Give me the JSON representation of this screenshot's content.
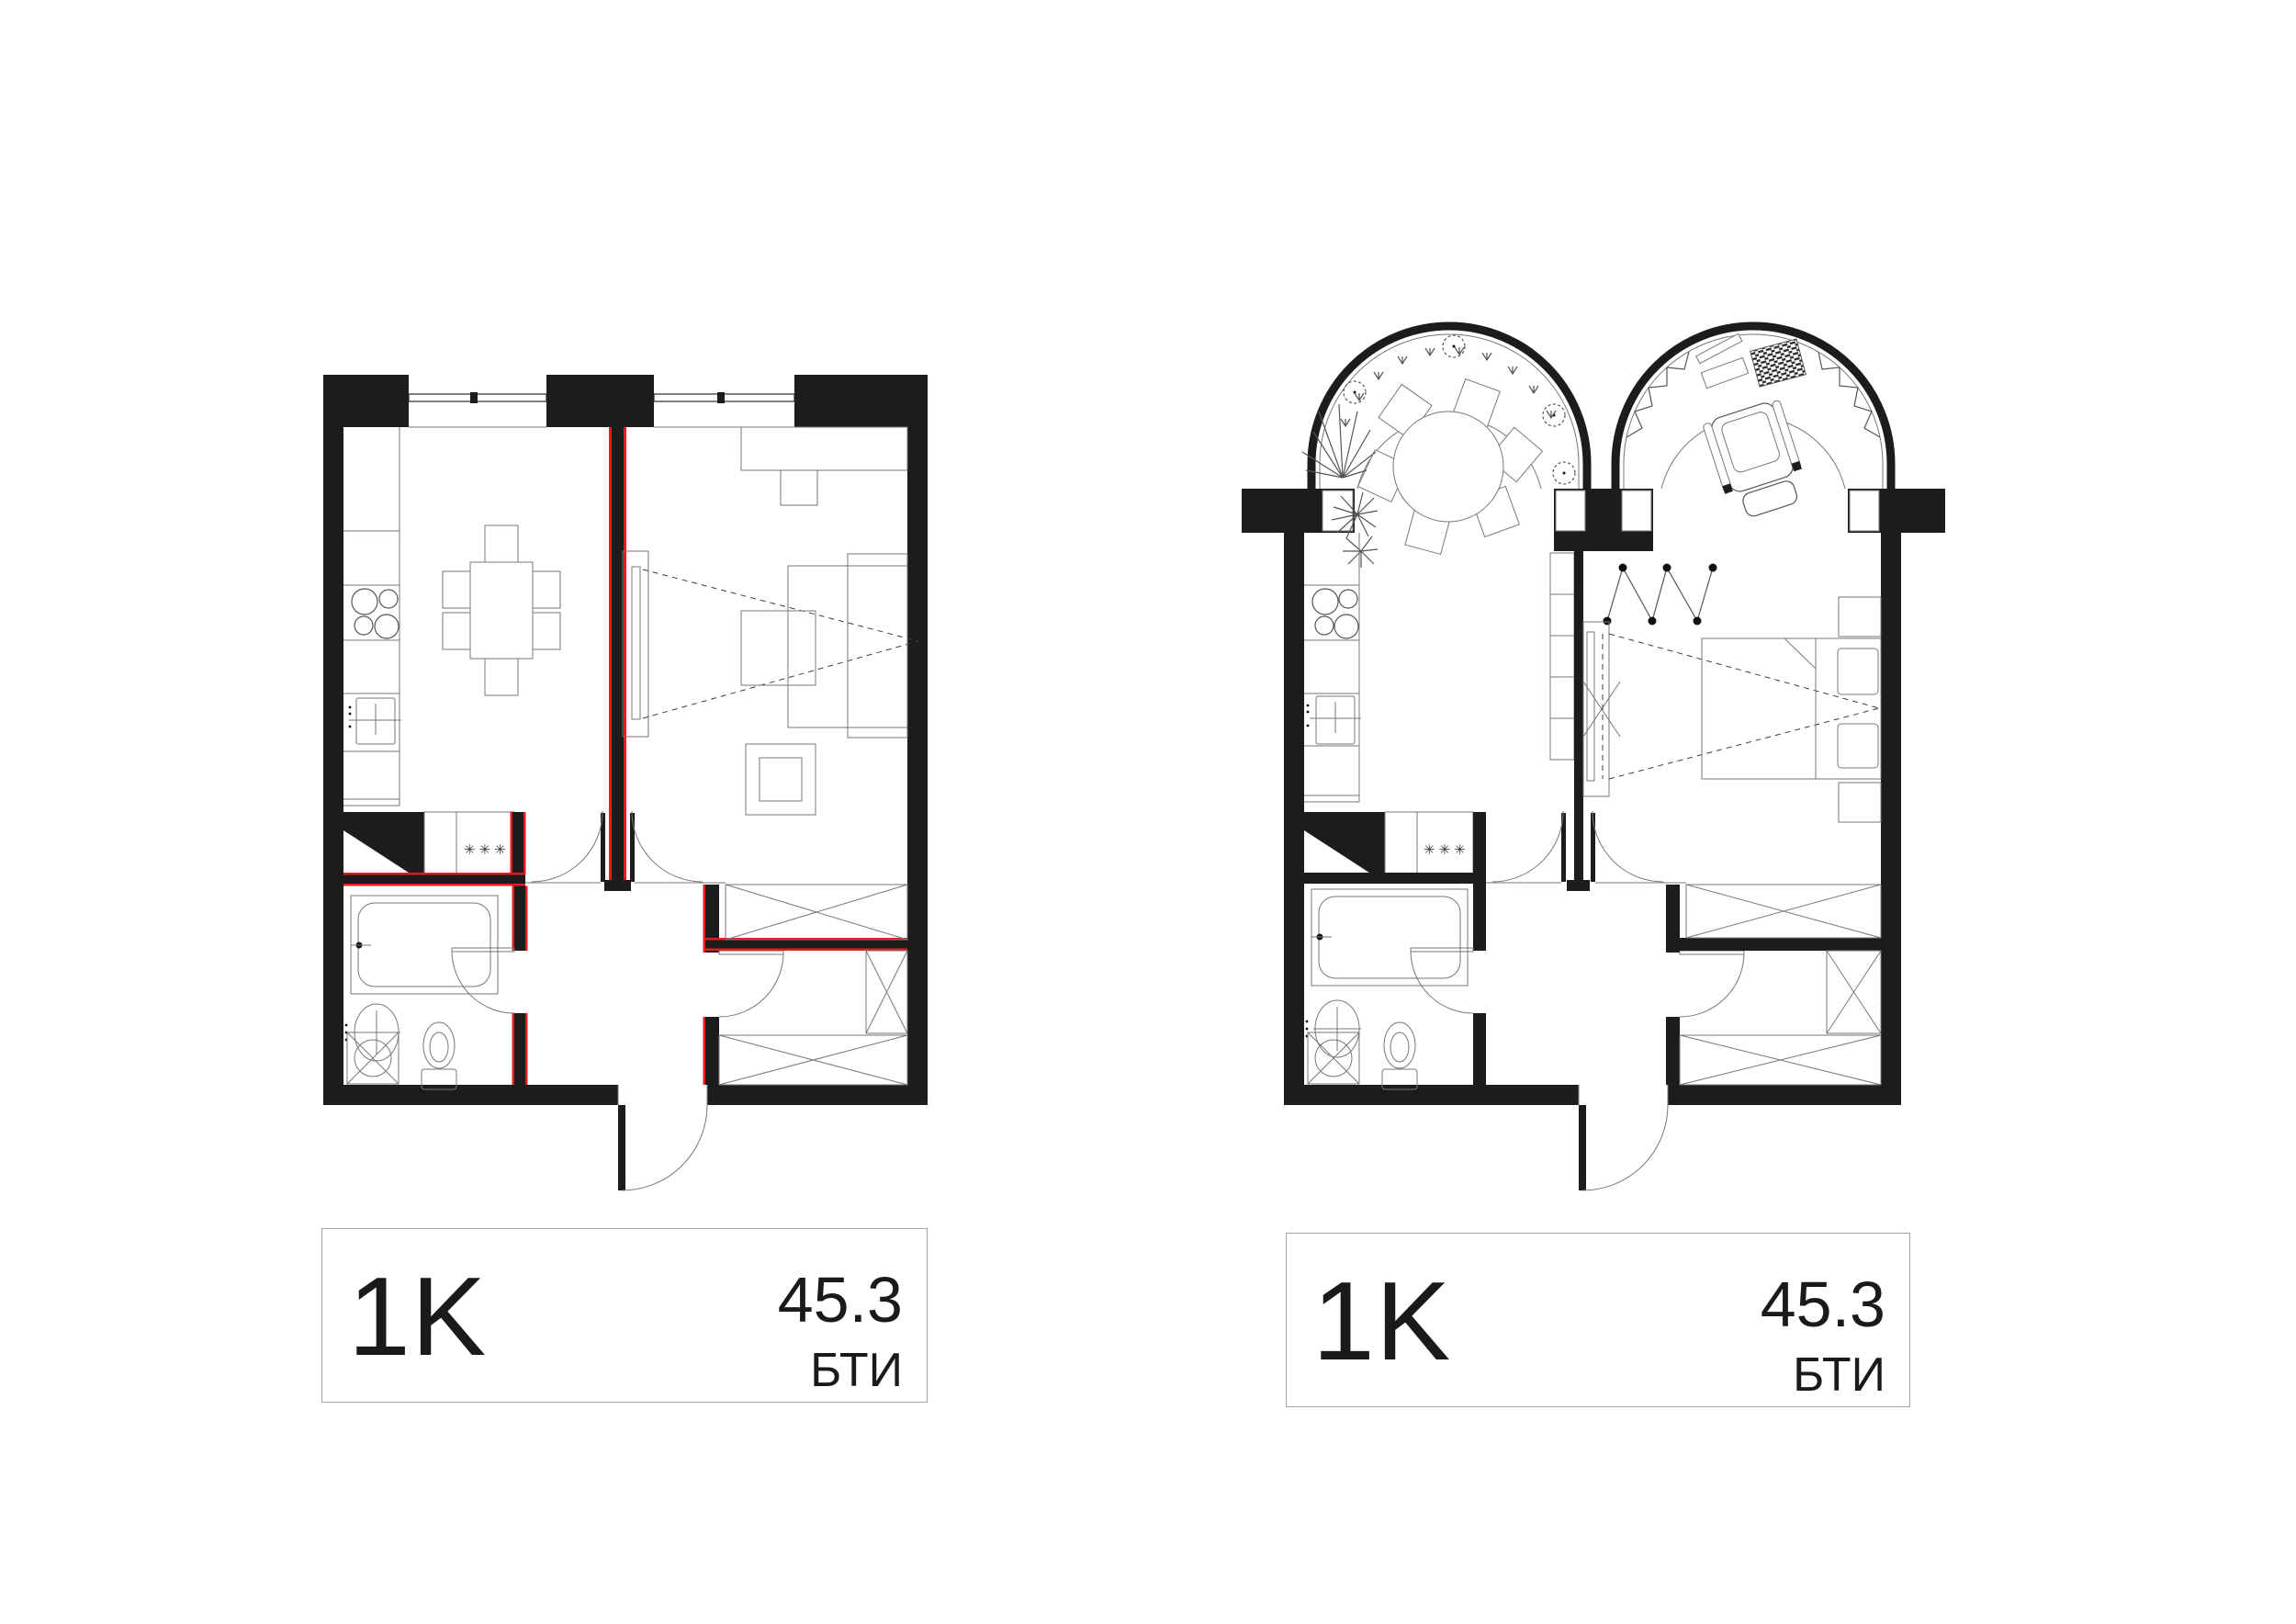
{
  "document": {
    "background": "#ffffff"
  },
  "colors": {
    "wall": "#1c1c1c",
    "new_partition_red": "#e8191f",
    "furniture_line": "#777777",
    "label_border": "#a3a3a3"
  },
  "plans": [
    {
      "id": "left",
      "type_label": "1K",
      "area_value": "45.3",
      "area_agency": "БТИ",
      "laundry_stars": "✳✳✳"
    },
    {
      "id": "right",
      "type_label": "1K",
      "area_value": "45.3",
      "area_agency": "БТИ",
      "laundry_stars": "✳✳✳"
    }
  ]
}
